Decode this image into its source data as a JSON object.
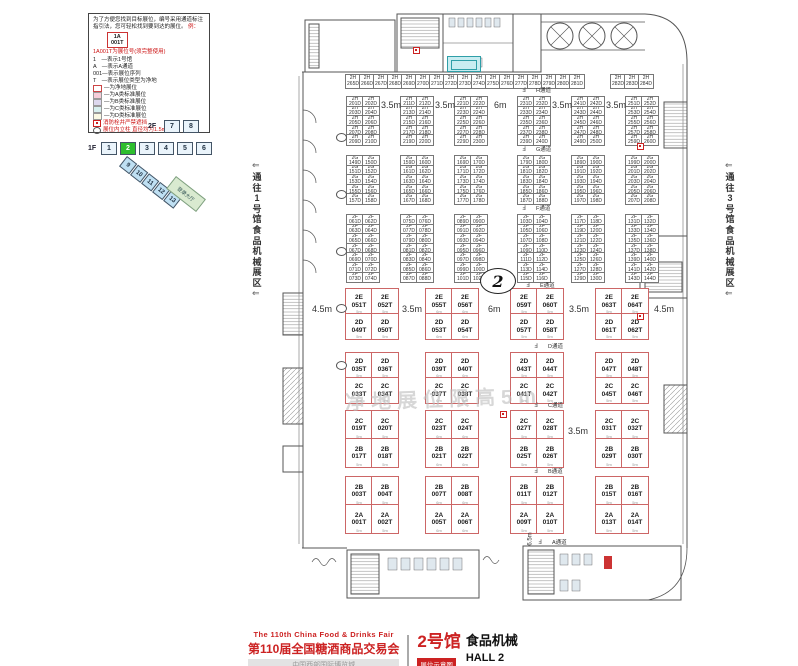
{
  "legend": {
    "intro": "为了方便您找到目标展位，编号采用通道标注指引法，您可轻松找到要到达的展位。",
    "example_label": "例：",
    "example_booth": "1A\n001T",
    "title_note": "1A001T为展位号(须完整使用)",
    "items": [
      "1　—表示1号馆",
      "A　—表示A通道",
      "001—表示展位序列",
      "T　—表示展位类型为净地"
    ],
    "swatches": [
      {
        "color": "#ffffff",
        "border": "#cc4444",
        "label": "—为净地展位"
      },
      {
        "color": "#f6cdd9",
        "border": "#999999",
        "label": "—为A类标准展位"
      },
      {
        "color": "#ddd8ee",
        "border": "#999999",
        "label": "—为B类标准展位"
      },
      {
        "color": "#d8f0ef",
        "border": "#999999",
        "label": "—为C类标准展位"
      },
      {
        "color": "#fbf9e4",
        "border": "#999999",
        "label": "—为D类标准展位"
      }
    ],
    "hydrant_note": "消防栓井严禁遮挡",
    "pillar_note": "展位内立柱 直径均为1.5m"
  },
  "minimap": {
    "floor2_label": "2F",
    "floor2_halls": [
      "7",
      "8"
    ],
    "floor1_label": "1F",
    "floor1_halls": [
      "1",
      "2",
      "3",
      "4",
      "5",
      "6"
    ],
    "active_hall": "2",
    "diagonal_halls": [
      "9",
      "10",
      "11",
      "12",
      "13"
    ],
    "annex_label": "登录大厅"
  },
  "corridors": {
    "left": "通往1号馆食品机械展区",
    "right": "通往3号馆食品机械展区",
    "arrow": "⇐"
  },
  "plan": {
    "hall_circle": "2",
    "watermark": "净地展位限高5m",
    "door_glyph": "Ⅎ",
    "block_xs": [
      345,
      425,
      510,
      595
    ],
    "cell_w": 26,
    "aisles": [
      {
        "label": "H通道",
        "x": 536,
        "y": 86
      },
      {
        "label": "G通道",
        "x": 536,
        "y": 145
      },
      {
        "label": "F通道",
        "x": 536,
        "y": 204
      },
      {
        "label": "E通道",
        "x": 540,
        "y": 281
      },
      {
        "label": "D通道",
        "x": 548,
        "y": 342
      },
      {
        "label": "C通道",
        "x": 548,
        "y": 401
      },
      {
        "label": "B通道",
        "x": 548,
        "y": 467
      },
      {
        "label": "A通道",
        "x": 552,
        "y": 538
      }
    ],
    "dims": [
      {
        "text": "3.5m",
        "x": 381,
        "y": 100
      },
      {
        "text": "3.5m",
        "x": 435,
        "y": 100
      },
      {
        "text": "6m",
        "x": 494,
        "y": 100
      },
      {
        "text": "3.5m",
        "x": 552,
        "y": 100
      },
      {
        "text": "3.5m",
        "x": 606,
        "y": 100
      },
      {
        "text": "4.5m",
        "x": 312,
        "y": 304
      },
      {
        "text": "3.5m",
        "x": 402,
        "y": 304
      },
      {
        "text": "6m",
        "x": 488,
        "y": 304
      },
      {
        "text": "3.5m",
        "x": 569,
        "y": 304
      },
      {
        "text": "4.5m",
        "x": 654,
        "y": 304
      },
      {
        "text": "3.5m",
        "x": 568,
        "y": 426
      }
    ],
    "vdim": {
      "text": "6.5m",
      "x": 524,
      "y": 536
    },
    "upper_strip": {
      "y": 74,
      "h": 13,
      "prefix": "2H",
      "suffix": "D",
      "start": 265,
      "groups": [
        {
          "x": 345,
          "cells": 17,
          "w": 14
        },
        {
          "x": 610,
          "cells": 3,
          "w": 14
        }
      ]
    },
    "upper_bands": [
      {
        "y": 96,
        "rows": 5,
        "row_h": 9.6,
        "col_w": 16,
        "xs": [
          346,
          400,
          454,
          517,
          571,
          625
        ],
        "prefix": "2H",
        "suffix": "D",
        "start": 201
      },
      {
        "y": 155,
        "rows": 5,
        "row_h": 9.6,
        "col_w": 16,
        "xs": [
          346,
          400,
          454,
          517,
          571,
          625
        ],
        "prefix": "2G",
        "suffix": "D",
        "start": 149
      },
      {
        "y": 214,
        "rows": 7,
        "row_h": 9.6,
        "col_w": 16,
        "xs": [
          346,
          400,
          454,
          517,
          571,
          625
        ],
        "prefix": "2F",
        "suffix": "D",
        "start": 61
      }
    ],
    "red_rows": [
      {
        "y": 288,
        "cell_h": 25,
        "top": [
          "2E 051T",
          "2E 052T",
          "2E 055T",
          "2E 056T",
          "2E 059T",
          "2E 060T",
          "2E 063T",
          "2E 064T"
        ],
        "bot": [
          "2D 049T",
          "2D 050T",
          "2D 053T",
          "2D 054T",
          "2D 057T",
          "2D 058T",
          "2D 061T",
          "2D 062T"
        ]
      },
      {
        "y": 352,
        "cell_h": 25,
        "top": [
          "2D 035T",
          "2D 036T",
          "2D 039T",
          "2D 040T",
          "2D 043T",
          "2D 044T",
          "2D 047T",
          "2D 048T"
        ],
        "bot": [
          "2C 033T",
          "2C 034T",
          "2C 037T",
          "2C 038T",
          "2C 041T",
          "2C 042T",
          "2C 045T",
          "2C 046T"
        ]
      },
      {
        "y": 410,
        "cell_h": 28,
        "top": [
          "2C 019T",
          "2C 020T",
          "2C 023T",
          "2C 024T",
          "2C 027T",
          "2C 028T",
          "2C 031T",
          "2C 032T"
        ],
        "bot": [
          "2B 017T",
          "2B 018T",
          "2B 021T",
          "2B 022T",
          "2B 025T",
          "2B 026T",
          "2B 029T",
          "2B 030T"
        ]
      },
      {
        "y": 476,
        "cell_h": 28,
        "top": [
          "2B 003T",
          "2B 004T",
          "2B 007T",
          "2B 008T",
          "2B 011T",
          "2B 012T",
          "2B 015T",
          "2B 016T"
        ],
        "bot": [
          "2A 001T",
          "2A 002T",
          "2A 005T",
          "2A 006T",
          "2A 009T",
          "2A 010T",
          "2A 013T",
          "2A 014T"
        ]
      }
    ],
    "booth_size_labels": [
      "5m",
      "6m",
      "5m",
      "5m"
    ],
    "hydrants": [
      [
        413,
        47
      ],
      [
        637,
        143
      ],
      [
        637,
        313
      ],
      [
        500,
        411
      ]
    ],
    "pillars": [
      [
        336,
        133
      ],
      [
        336,
        190
      ],
      [
        336,
        247
      ],
      [
        336,
        304
      ],
      [
        336,
        361
      ]
    ]
  },
  "footer": {
    "fair_en": "The 110th China Food & Drinks Fair",
    "fair_cn": "第110届全国糖酒商品交易会",
    "venue": "中国西部国际博览城",
    "hall_cn": "2号馆",
    "hall_food_cn": "食品机械",
    "badge": "展位示意图",
    "hall_en": "HALL 2",
    "hall_food_en": "FOOD MACHINERY"
  }
}
